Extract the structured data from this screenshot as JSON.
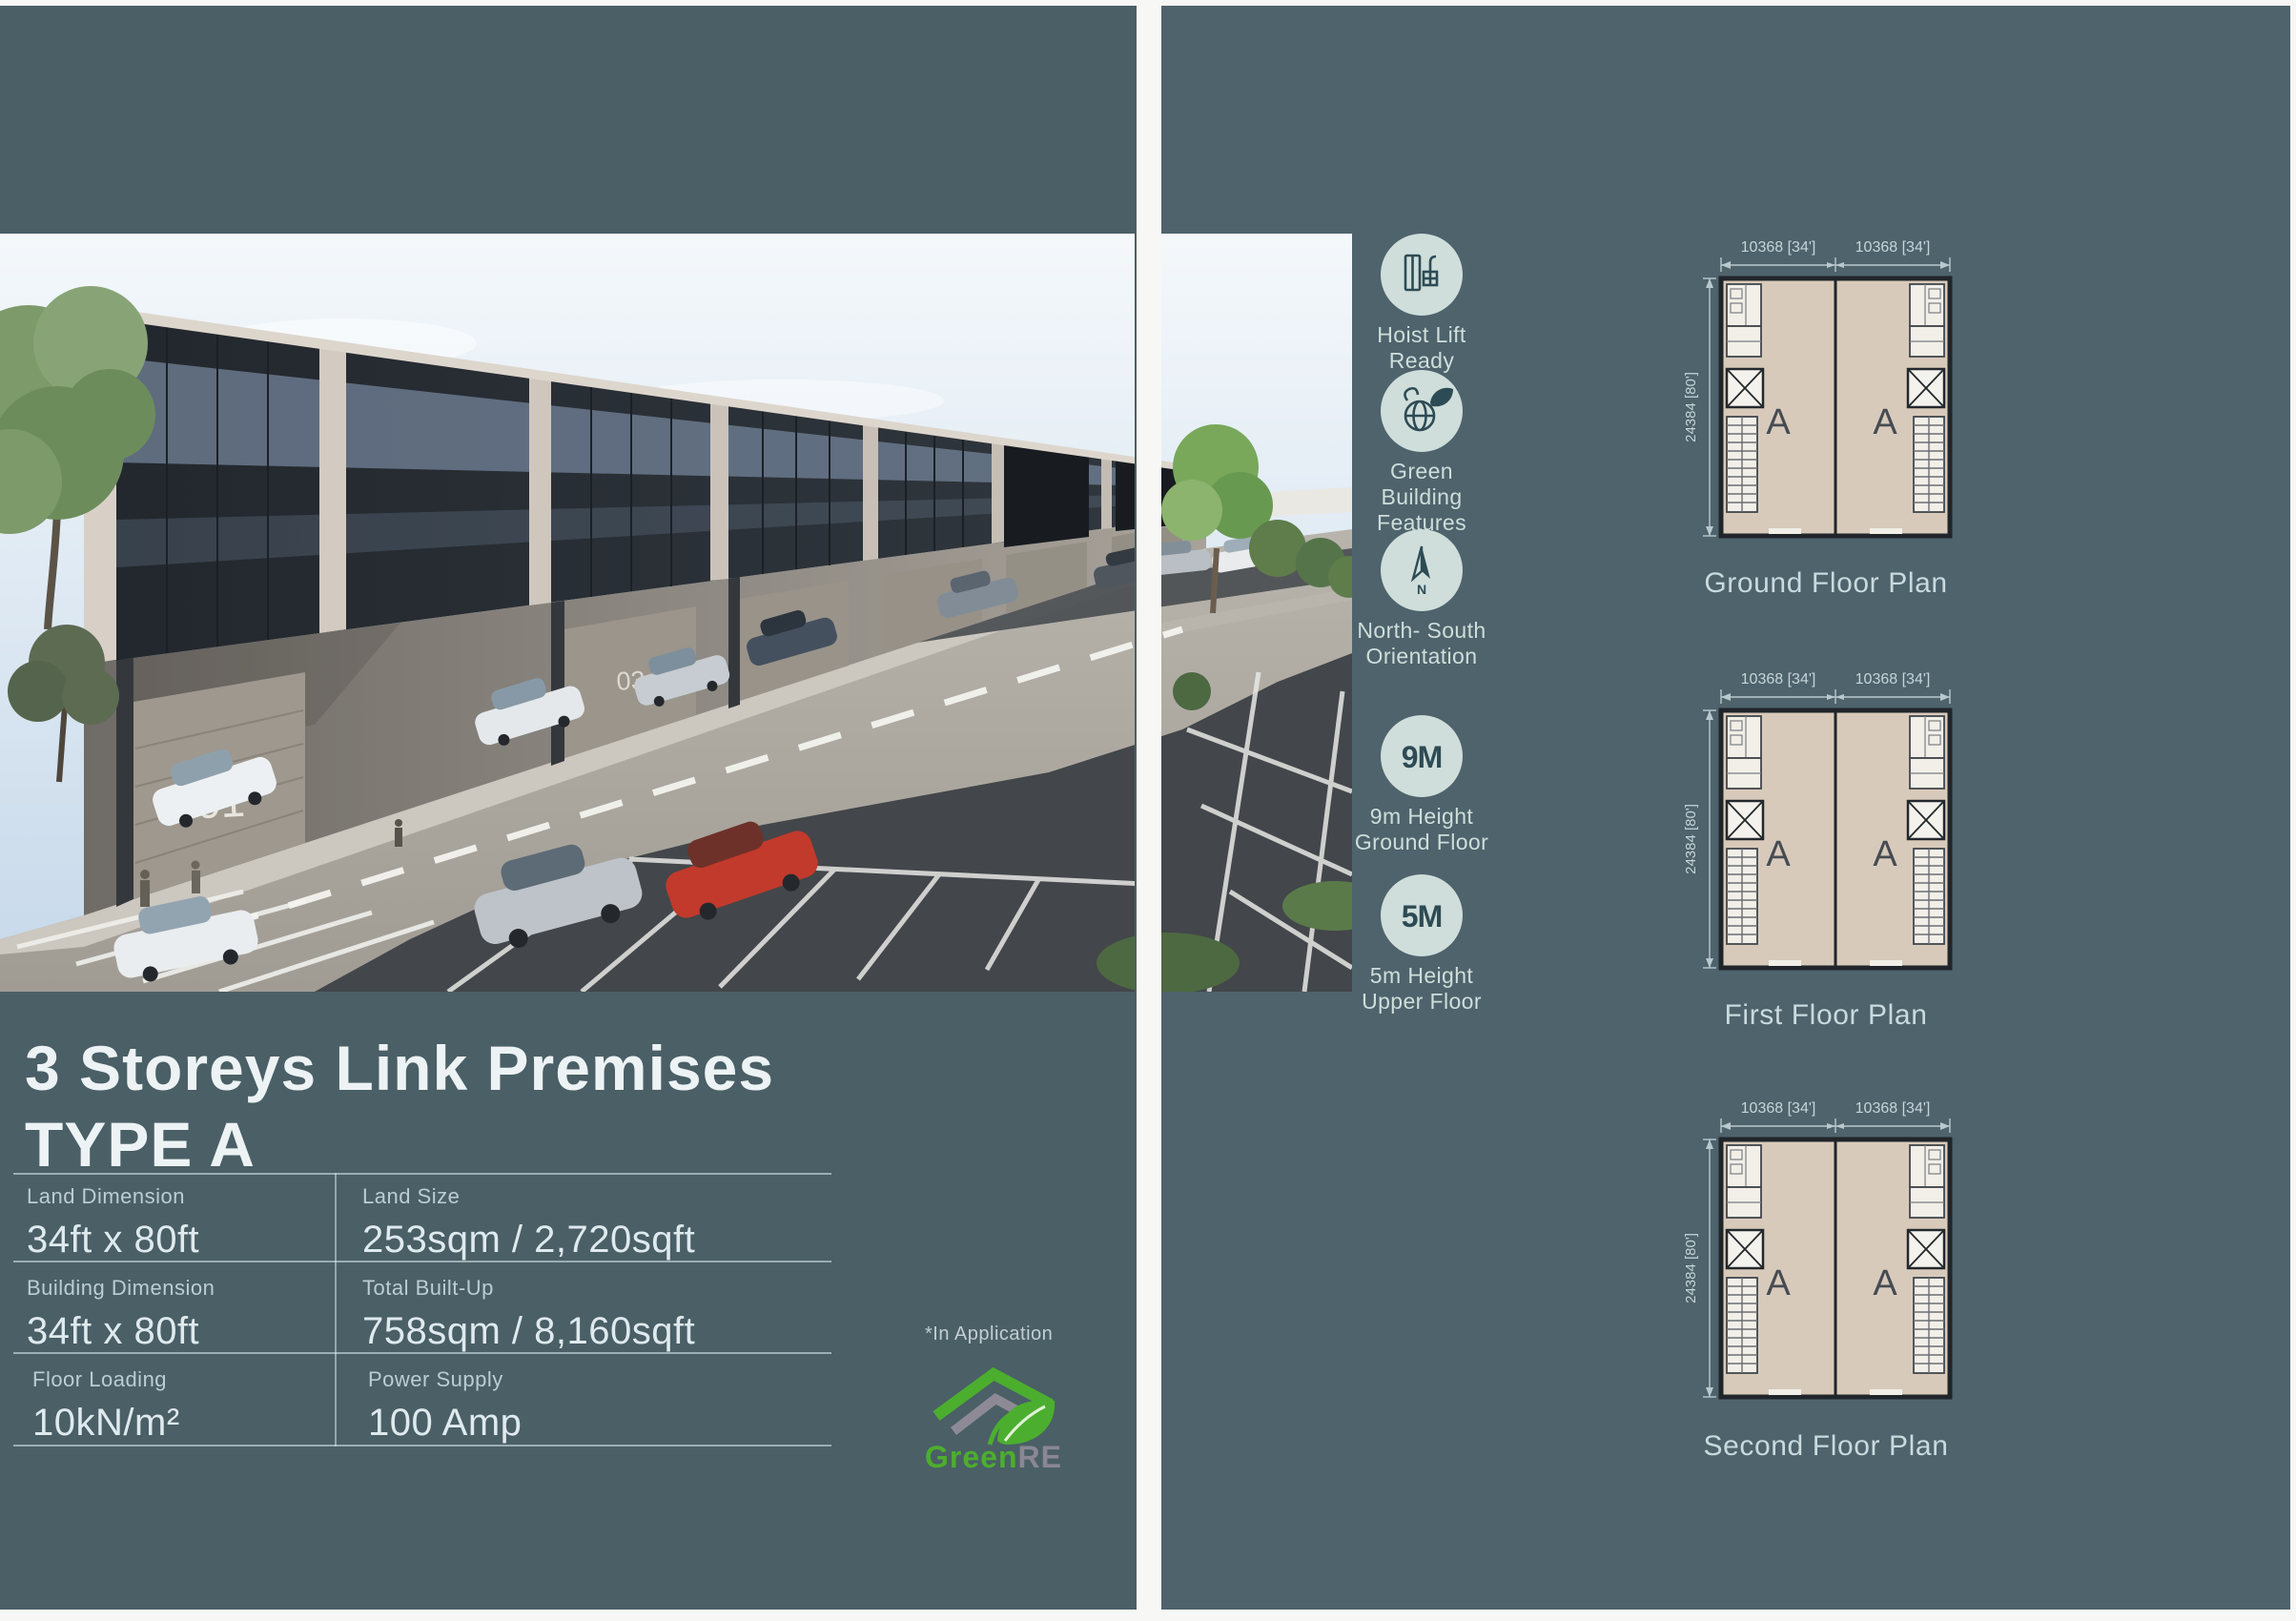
{
  "brochure": {
    "title": {
      "line1": "3 Storeys Link Premises",
      "line2": "TYPE A"
    },
    "specs": [
      {
        "label": "Land Dimension",
        "value": "34ft x 80ft"
      },
      {
        "label": "Land Size",
        "value": "253sqm / 2,720sqft"
      },
      {
        "label": "Building Dimension",
        "value": "34ft x 80ft"
      },
      {
        "label": "Total Built-Up",
        "value": "758sqm / 8,160sqft"
      },
      {
        "label": "Floor Loading",
        "value": "10kN/m²"
      },
      {
        "label": "Power Supply",
        "value": "100 Amp"
      }
    ],
    "certification": {
      "note": "*In Application",
      "brand_green": "Green",
      "brand_grey": "RE"
    },
    "photo": {
      "unit_number_front": "01",
      "unit_number_mid": "03"
    },
    "features": [
      {
        "icon": "hoist-lift-icon",
        "lines": [
          "Hoist Lift",
          "Ready"
        ]
      },
      {
        "icon": "green-building-icon",
        "lines": [
          "Green",
          "Building",
          "Features"
        ]
      },
      {
        "icon": "north-south-icon",
        "compass_letter": "N",
        "lines": [
          "North- South",
          "Orientation"
        ]
      },
      {
        "icon": "height-9m-icon",
        "badge": "9M",
        "lines": [
          "9m Height",
          "Ground Floor"
        ]
      },
      {
        "icon": "height-5m-icon",
        "badge": "5M",
        "lines": [
          "5m Height",
          "Upper Floor"
        ]
      }
    ],
    "floor_plans": [
      {
        "name": "Ground Floor Plan",
        "dim_top_left": "10368 [34']",
        "dim_top_right": "10368 [34']",
        "dim_side": "24384 [80']",
        "units": [
          "A",
          "A"
        ]
      },
      {
        "name": "First Floor Plan",
        "dim_top_left": "10368 [34']",
        "dim_top_right": "10368 [34']",
        "dim_side": "24384 [80']",
        "units": [
          "A",
          "A"
        ]
      },
      {
        "name": "Second Floor Plan",
        "dim_top_left": "10368 [34']",
        "dim_top_right": "10368 [34']",
        "dim_side": "24384 [80']",
        "units": [
          "A",
          "A"
        ]
      }
    ],
    "colors": {
      "page_bg_left": "#4a5f66",
      "page_bg_right": "#4e636c",
      "icon_circle": "#cfdeda",
      "icon_ink": "#2d4b55",
      "plan_floor": "#d8cabb",
      "brand_green": "#4cae2e",
      "brand_grey": "#8d8a96"
    }
  }
}
